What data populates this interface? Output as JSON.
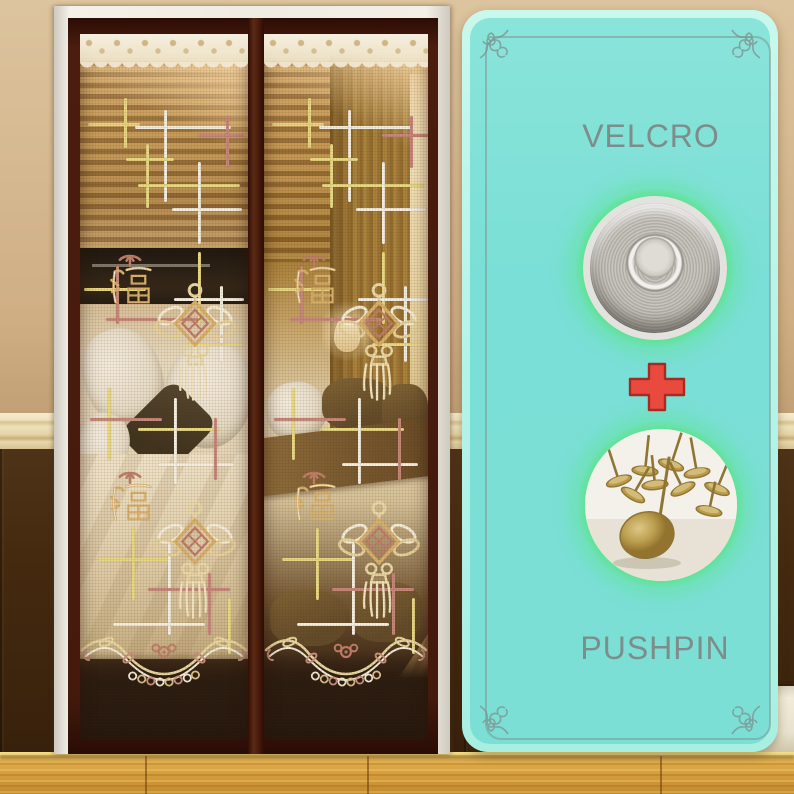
{
  "scene": {
    "description": "Magnetic mesh screen door curtain installed in a bedroom doorway",
    "wall_color": "#cfae84",
    "wainscot_color": "#44290f",
    "chair_rail_color": "#eee1ba",
    "baseboard_color": "#f1ebd9",
    "floor_color": "#dca645"
  },
  "door": {
    "outer_frame_color": "#efece3",
    "frame_color": "#471b0d",
    "lace_color": "#f2e9d2",
    "fu_character": "福",
    "ornament_name": "chinese-knot-with-tassel",
    "pattern_colors": {
      "yellow": "#eadc85",
      "white": "#f7f3e8",
      "rose": "#c5857b"
    }
  },
  "promo_card": {
    "bg_color": "#7adfd6",
    "edge_color": "#b5f3e7",
    "border_line_color": "#7d9693",
    "glow_color": "#5ee392",
    "label_color": "#7e8d8b",
    "plus_color": "#e8473c",
    "velcro_label": "VELCRO",
    "plus_symbol": "+",
    "pushpin_label": "PUSHPIN",
    "velcro_image": "velcro-dot-photo",
    "pushpin_image": "pushpin-photo"
  }
}
